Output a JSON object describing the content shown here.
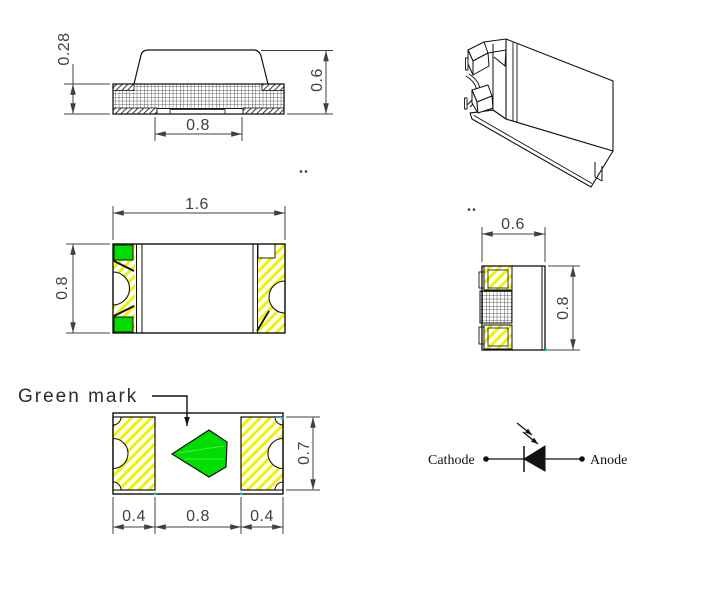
{
  "labels": {
    "green_mark": "Green mark",
    "cathode": "Cathode",
    "anode": "Anode"
  },
  "dimensions": {
    "side_view": {
      "terminal_thickness": "0.28",
      "total_height": "0.6",
      "bottom_gap": "0.8"
    },
    "top_view": {
      "length": "1.6",
      "width": "0.8"
    },
    "end_view": {
      "width": "0.6",
      "height": "0.8"
    },
    "bottom_view": {
      "left_pad_width": "0.4",
      "center_gap": "0.8",
      "right_pad_width": "0.4",
      "pad_height": "0.7"
    }
  },
  "colors": {
    "terminal_hatch_yellow": "#f2f200",
    "green_mark": "#00dd00",
    "outline_black": "#111111",
    "dimension_gray": "#404040",
    "endpoint_marker_cyan": "#00c8c8"
  }
}
